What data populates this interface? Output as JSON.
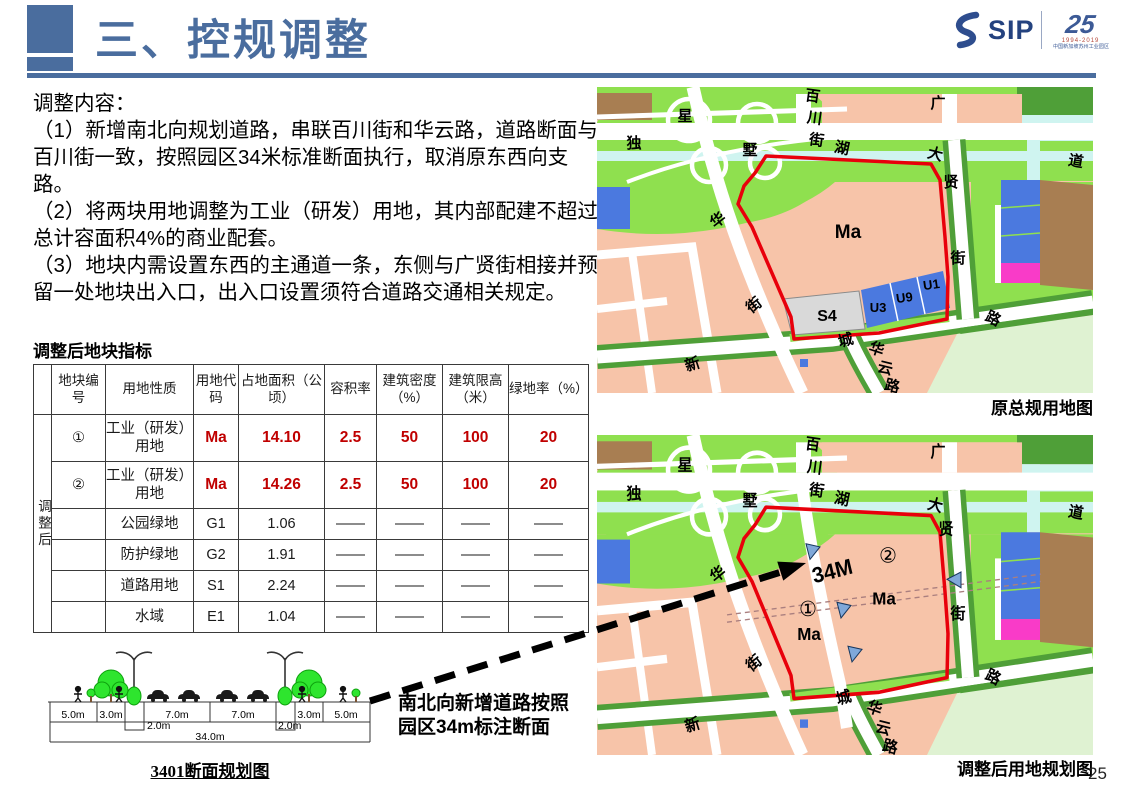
{
  "page": {
    "number": "25"
  },
  "header": {
    "title": "三、控规调整",
    "logo": {
      "sip": "SIP",
      "anniversary": "25",
      "years": "1994-2019",
      "org": "中国新加坡苏州工业园区"
    }
  },
  "content": {
    "heading": "调整内容：",
    "items": [
      "（1）新增南北向规划道路，串联百川街和华云路，道路断面与百川街一致，按照园区34米标准断面执行，取消原东西向支路。",
      "（2）将两块用地调整为工业（研发）用地，其内部配建不超过总计容面积4%的商业配套。",
      "（3）地块内需设置东西的主通道一条，东侧与广贤街相接并预留一处地块出入口，出入口设置须符合道路交通相关规定。"
    ]
  },
  "table": {
    "title": "调整后地块指标",
    "group_label": "调整后",
    "headers": [
      "地块编号",
      "用地性质",
      "用地代码",
      "占地面积（公顷）",
      "容积率",
      "建筑密度（%）",
      "建筑限高（米）",
      "绿地率（%）"
    ],
    "rows": [
      {
        "no": "①",
        "nature": "工业（研发）用地",
        "code": "Ma",
        "area": "14.10",
        "far": "2.5",
        "density": "50",
        "height": "100",
        "green": "20",
        "hl": true
      },
      {
        "no": "②",
        "nature": "工业（研发）用地",
        "code": "Ma",
        "area": "14.26",
        "far": "2.5",
        "density": "50",
        "height": "100",
        "green": "20",
        "hl": true
      },
      {
        "no": "",
        "nature": "公园绿地",
        "code": "G1",
        "area": "1.06",
        "far": "——",
        "density": "——",
        "height": "——",
        "green": "——",
        "hl": false
      },
      {
        "no": "",
        "nature": "防护绿地",
        "code": "G2",
        "area": "1.91",
        "far": "——",
        "density": "——",
        "height": "——",
        "green": "——",
        "hl": false
      },
      {
        "no": "",
        "nature": "道路用地",
        "code": "S1",
        "area": "2.24",
        "far": "——",
        "density": "——",
        "height": "——",
        "green": "——",
        "hl": false
      },
      {
        "no": "",
        "nature": "水域",
        "code": "E1",
        "area": "1.04",
        "far": "——",
        "density": "——",
        "height": "——",
        "green": "——",
        "hl": false
      }
    ]
  },
  "section": {
    "caption": "3401断面规划图",
    "dims": [
      {
        "t": "5.0m",
        "x": 33,
        "y": 75
      },
      {
        "t": "3.0m",
        "x": 71,
        "y": 75
      },
      {
        "t": "7.0m",
        "x": 137,
        "y": 75
      },
      {
        "t": "7.0m",
        "x": 203,
        "y": 75
      },
      {
        "t": "3.0m",
        "x": 269,
        "y": 75
      },
      {
        "t": "5.0m",
        "x": 306,
        "y": 75
      }
    ],
    "dims2": [
      {
        "t": "2.0m",
        "x": 107,
        "y": 86,
        "a": "start"
      },
      {
        "t": "2.0m",
        "x": 238,
        "y": 86,
        "a": "start"
      }
    ],
    "total": {
      "t": "34.0m",
      "x": 170,
      "y": 97
    }
  },
  "annotation": {
    "line1": "南北向新增道路按照",
    "line2": "园区34m标注断面"
  },
  "maps": {
    "top": {
      "caption": "原总规用地图",
      "streets": [
        {
          "t": "星",
          "x": 88,
          "y": 34
        },
        {
          "t": "独",
          "x": 37,
          "y": 61
        },
        {
          "t": "墅",
          "x": 153,
          "y": 68
        },
        {
          "t": "百",
          "x": 215,
          "y": 14,
          "r": 8
        },
        {
          "t": "川",
          "x": 217,
          "y": 36,
          "r": 8
        },
        {
          "t": "街",
          "x": 219,
          "y": 58,
          "r": 8
        },
        {
          "t": "湖",
          "x": 244,
          "y": 66,
          "r": 12
        },
        {
          "t": "大",
          "x": 337,
          "y": 72,
          "r": 14
        },
        {
          "t": "道",
          "x": 478,
          "y": 79,
          "r": 10
        },
        {
          "t": "广",
          "x": 341,
          "y": 21
        },
        {
          "t": "贤",
          "x": 354,
          "y": 100
        },
        {
          "t": "街",
          "x": 361,
          "y": 176
        },
        {
          "t": "华",
          "x": 124,
          "y": 137,
          "r": -38
        },
        {
          "t": "街",
          "x": 160,
          "y": 222,
          "r": -38
        },
        {
          "t": "城",
          "x": 250,
          "y": 258,
          "r": -15
        },
        {
          "t": "华",
          "x": 278,
          "y": 267,
          "r": 18
        },
        {
          "t": "云",
          "x": 287,
          "y": 286,
          "r": 14
        },
        {
          "t": "路",
          "x": 294,
          "y": 304,
          "r": 14
        },
        {
          "t": "新",
          "x": 97,
          "y": 282,
          "r": -18
        },
        {
          "t": "路",
          "x": 394,
          "y": 236,
          "r": 26
        }
      ],
      "zones": [
        {
          "t": "Ma",
          "x": 251,
          "y": 151,
          "s": 19
        },
        {
          "t": "S4",
          "x": 230,
          "y": 234,
          "s": 16
        },
        {
          "t": "U3",
          "x": 281,
          "y": 225,
          "s": 13
        },
        {
          "t": "U9",
          "x": 308,
          "y": 215,
          "s": 13,
          "r": -8
        },
        {
          "t": "U1",
          "x": 335,
          "y": 202,
          "s": 13,
          "r": -8
        }
      ]
    },
    "bottom": {
      "caption": "调整后用地规划图",
      "streets": [
        {
          "t": "星",
          "x": 88,
          "y": 34
        },
        {
          "t": "独",
          "x": 37,
          "y": 61
        },
        {
          "t": "墅",
          "x": 153,
          "y": 68
        },
        {
          "t": "百",
          "x": 215,
          "y": 14,
          "r": 8
        },
        {
          "t": "川",
          "x": 217,
          "y": 36,
          "r": 8
        },
        {
          "t": "街",
          "x": 219,
          "y": 58,
          "r": 8
        },
        {
          "t": "湖",
          "x": 244,
          "y": 66,
          "r": 12
        },
        {
          "t": "大",
          "x": 337,
          "y": 72,
          "r": 14
        },
        {
          "t": "道",
          "x": 478,
          "y": 79,
          "r": 10
        },
        {
          "t": "广",
          "x": 341,
          "y": 21
        },
        {
          "t": "贤",
          "x": 349,
          "y": 95
        },
        {
          "t": "街",
          "x": 361,
          "y": 176
        },
        {
          "t": "华",
          "x": 124,
          "y": 137,
          "r": -38
        },
        {
          "t": "街",
          "x": 160,
          "y": 222,
          "r": -38
        },
        {
          "t": "城",
          "x": 248,
          "y": 256,
          "r": -15
        },
        {
          "t": "华",
          "x": 276,
          "y": 266,
          "r": 18
        },
        {
          "t": "云",
          "x": 285,
          "y": 285,
          "r": 14
        },
        {
          "t": "路",
          "x": 292,
          "y": 303,
          "r": 14
        },
        {
          "t": "新",
          "x": 97,
          "y": 282,
          "r": -18
        },
        {
          "t": "路",
          "x": 394,
          "y": 236,
          "r": 26
        }
      ],
      "zones": [
        {
          "t": "34M",
          "x": 237,
          "y": 137,
          "s": 21,
          "r": -14
        },
        {
          "t": "②",
          "x": 291,
          "y": 122,
          "s": 20,
          "b": 0
        },
        {
          "t": "Ma",
          "x": 287,
          "y": 162,
          "s": 17
        },
        {
          "t": "①",
          "x": 211,
          "y": 173,
          "s": 20,
          "b": 0
        },
        {
          "t": "Ma",
          "x": 212,
          "y": 196,
          "s": 17
        }
      ]
    }
  }
}
